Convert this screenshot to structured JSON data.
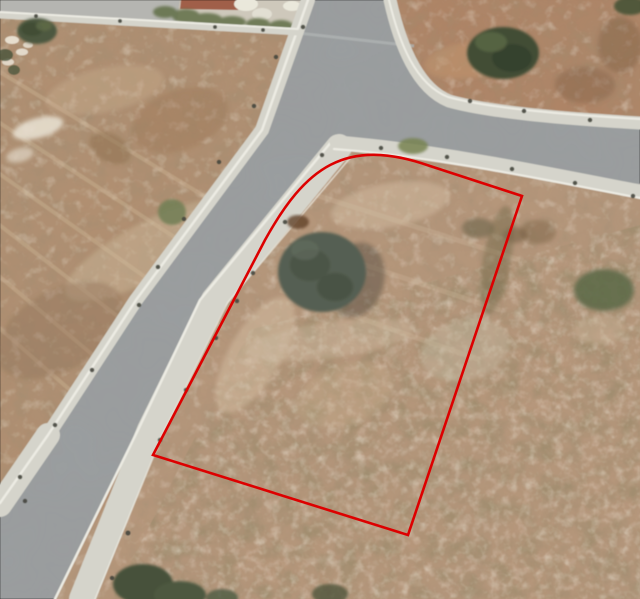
{
  "scene": {
    "kind": "aerial-satellite-photo",
    "subject": "vacant land plots with access roads, one plot outlined in red",
    "colors": {
      "road": "#989ca0",
      "sidewalk": "#d6d5cd",
      "curb_highlight": "#efeee6",
      "dirt_left_plot": "#b08d6e",
      "dirt_right_plot": "#b79579",
      "dirt_topright_plot": "#ae8162",
      "vegetation_dark": "#46523a",
      "outline_red": "#dd0000"
    }
  },
  "overlay": {
    "name": "plot-boundary",
    "shape": "polygon-with-rounded-top-left-corner",
    "color": "#dd0000",
    "stroke_width": 2.6,
    "path_d": "M 153 455 L 265 240 C 305 168 345 136 430 166 L 522 196 L 408 535 Z",
    "vertices": [
      [
        153,
        455
      ],
      [
        265,
        240
      ],
      [
        430,
        166
      ],
      [
        522,
        196
      ],
      [
        408,
        535
      ]
    ]
  },
  "features": {
    "roads": [
      {
        "name": "main-road-diagonal"
      },
      {
        "name": "branch-road-curving-right"
      }
    ],
    "trees": [
      {
        "name": "tree-left-plot",
        "x": 37,
        "y": 31
      },
      {
        "name": "bush-left-plot",
        "x": 172,
        "y": 212
      },
      {
        "name": "tree-topright-plot",
        "x": 503,
        "y": 53
      },
      {
        "name": "tree-topright-corner",
        "x": 630,
        "y": 6
      },
      {
        "name": "tree-inside-outlined-plot",
        "x": 322,
        "y": 272
      },
      {
        "name": "bush-right-edge",
        "x": 604,
        "y": 290
      },
      {
        "name": "bush-below-curb",
        "x": 413,
        "y": 146
      },
      {
        "name": "tree-mass-bottom",
        "x": 150,
        "y": 585
      }
    ]
  }
}
